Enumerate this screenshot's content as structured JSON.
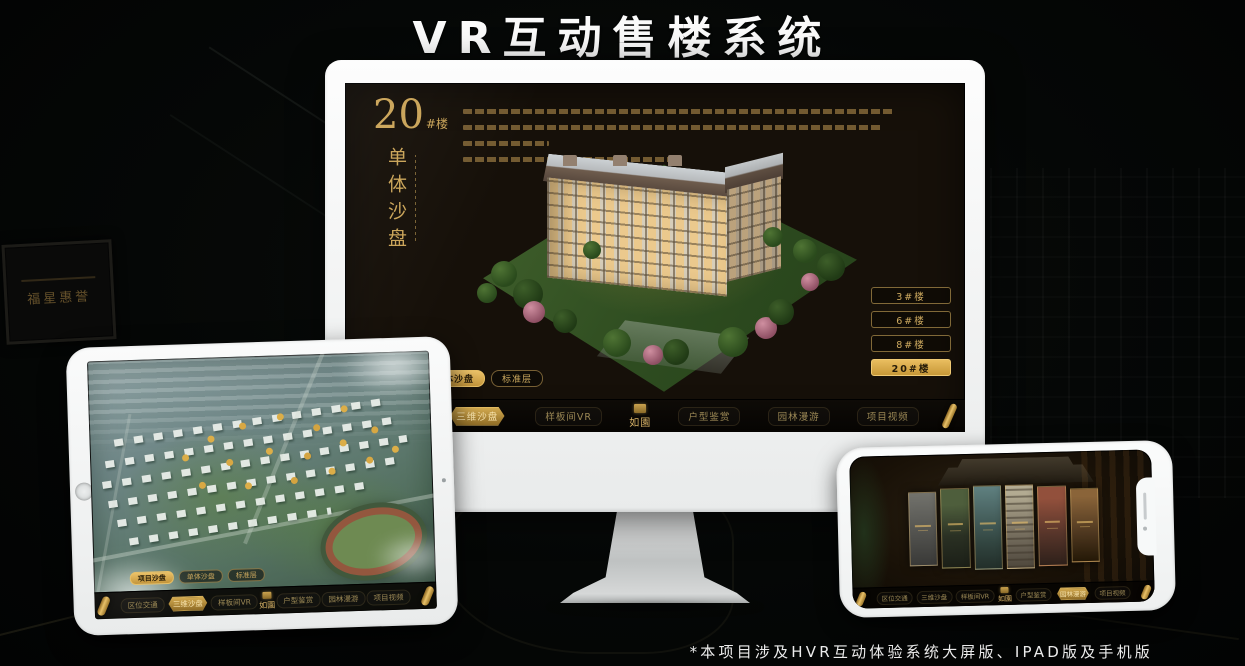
{
  "page": {
    "title": "VR互动售楼系统",
    "footnote": "*本项目涉及HVR互动体验系统大屏版、IPAD版及手机版"
  },
  "colors": {
    "gold": "#C9A252",
    "gold_active_bg": "#D8AC4E",
    "screen_bg": "#161009",
    "nav_bg": "#0A0805",
    "monitor_body": "#F2F3F3"
  },
  "background": {
    "plaque_text": "福星惠誉"
  },
  "monitor": {
    "screen": {
      "unit_number": "20",
      "unit_suffix": "#楼",
      "unit_title": "单体沙盘",
      "building_buttons": [
        {
          "label": "3#楼",
          "active": false
        },
        {
          "label": "6#楼",
          "active": false
        },
        {
          "label": "8#楼",
          "active": false
        },
        {
          "label": "20#楼",
          "active": true
        }
      ],
      "tabs": [
        {
          "label": "项目沙盘",
          "active": false
        },
        {
          "label": "单体沙盘",
          "active": true
        },
        {
          "label": "标准层",
          "active": false
        }
      ],
      "nav_items": [
        {
          "label": "区位交通",
          "active": false
        },
        {
          "label": "三维沙盘",
          "active": true
        },
        {
          "label": "样板间VR",
          "active": false
        },
        {
          "label": "户型鉴赏",
          "active": false
        },
        {
          "label": "园林漫游",
          "active": false
        },
        {
          "label": "项目视频",
          "active": false
        }
      ],
      "logo": "如園"
    }
  },
  "tablet": {
    "tabs": [
      {
        "label": "项目沙盘",
        "active": true
      },
      {
        "label": "单体沙盘",
        "active": false
      },
      {
        "label": "标准层",
        "active": false
      }
    ],
    "nav_items": [
      {
        "label": "区位交通",
        "active": false
      },
      {
        "label": "三维沙盘",
        "active": true
      },
      {
        "label": "样板间VR",
        "active": false
      },
      {
        "label": "户型鉴赏",
        "active": false
      },
      {
        "label": "园林漫游",
        "active": false
      },
      {
        "label": "项目视频",
        "active": false
      }
    ],
    "logo": "如園"
  },
  "phone": {
    "nav_items": [
      {
        "label": "区位交通",
        "active": false
      },
      {
        "label": "三维沙盘",
        "active": false
      },
      {
        "label": "样板间VR",
        "active": false
      },
      {
        "label": "户型鉴赏",
        "active": false
      },
      {
        "label": "园林漫游",
        "active": true
      },
      {
        "label": "项目视频",
        "active": false
      }
    ],
    "logo": "如園"
  }
}
